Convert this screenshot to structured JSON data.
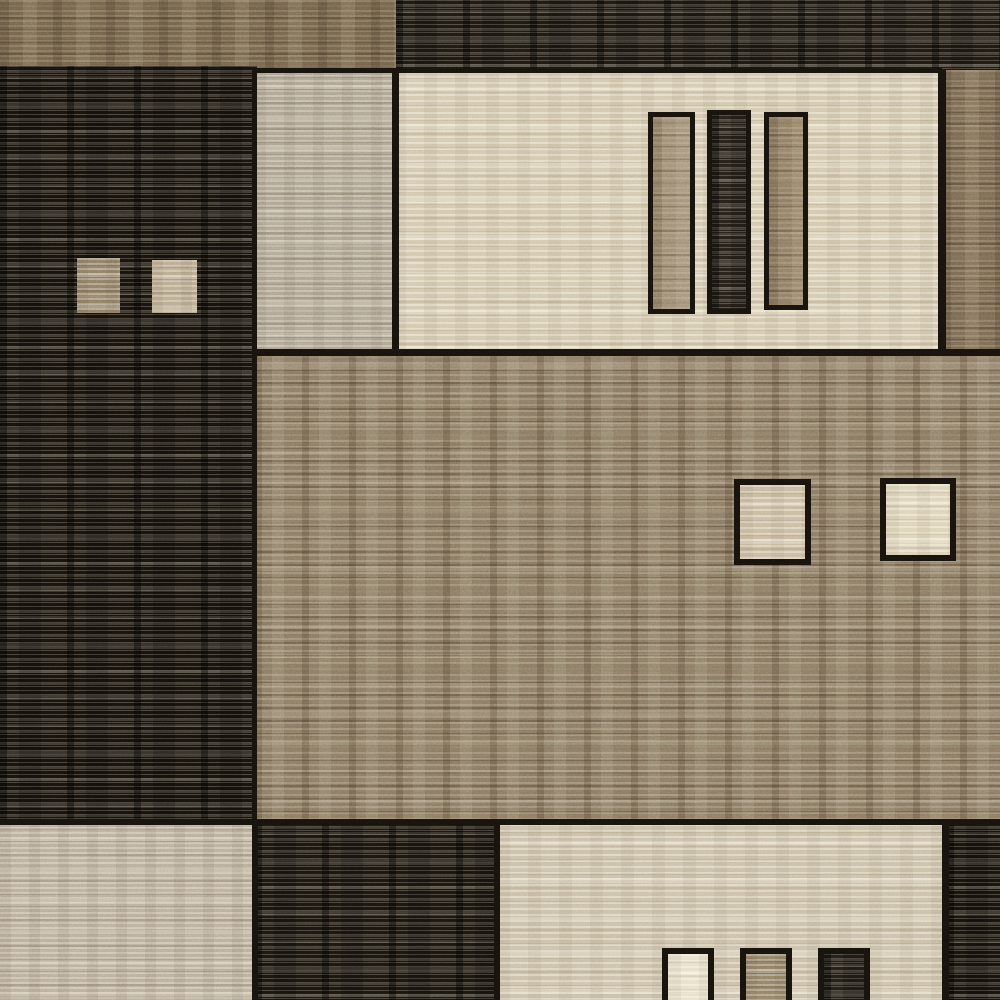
{
  "meta": {
    "description": "Close-up photograph of a geometric patchwork area rug in brown, taupe, beige and cream tones with horizontal woven striations",
    "width": 1000,
    "height": 1000
  },
  "palette": {
    "outline": "#17120d",
    "near_black": "#17120d",
    "dark_brown": "#1d1812",
    "taupe_brown": "#6f6049",
    "tan_field": "#85755f",
    "greige": "#aba08c",
    "cream": "#d2c6ab",
    "warm_beige": "#c9bda4",
    "gray_beige": "#b7ab96"
  },
  "blocks": [
    {
      "name": "top-brown-strip",
      "x": 0,
      "y": 0,
      "w": 396,
      "h": 72,
      "color": "#6f6049",
      "texture": "mottled"
    },
    {
      "name": "top-dark-strip",
      "x": 396,
      "y": 0,
      "w": 604,
      "h": 72,
      "color": "#1d1812",
      "texture": "darkstripes"
    },
    {
      "name": "left-dark-column",
      "x": 0,
      "y": 66,
      "w": 257,
      "h": 756,
      "color": "#17120d",
      "texture": "darkstripes"
    },
    {
      "name": "beige-left-sub-block",
      "x": 255,
      "y": 70,
      "w": 140,
      "h": 282,
      "color": "#aba08c",
      "texture": "stripes"
    },
    {
      "name": "beige-main-block",
      "x": 393,
      "y": 70,
      "w": 549,
      "h": 284,
      "color": "#d2c6ab",
      "texture": "lightstripes"
    },
    {
      "name": "right-brown-strip",
      "x": 942,
      "y": 70,
      "w": 58,
      "h": 286,
      "color": "#75654f",
      "texture": "mottled"
    },
    {
      "name": "tan-center-field",
      "x": 255,
      "y": 350,
      "w": 745,
      "h": 472,
      "color": "#85755f",
      "texture": "mottledstrong"
    },
    {
      "name": "bottom-left-beige-block",
      "x": 0,
      "y": 822,
      "w": 255,
      "h": 178,
      "color": "#b7ab96",
      "texture": "stripes"
    },
    {
      "name": "bottom-dark-block",
      "x": 255,
      "y": 822,
      "w": 242,
      "h": 178,
      "color": "#1a150f",
      "texture": "darkstripes"
    },
    {
      "name": "bottom-beige-block",
      "x": 497,
      "y": 824,
      "w": 450,
      "h": 176,
      "color": "#c9bda4",
      "texture": "lightstripes"
    },
    {
      "name": "bottom-right-dark-block",
      "x": 947,
      "y": 822,
      "w": 53,
      "h": 178,
      "color": "#17120d",
      "texture": "darkstripes"
    }
  ],
  "seams": [
    {
      "name": "seam-beige-top",
      "x": 255,
      "y": 68,
      "w": 687,
      "h": 5
    },
    {
      "name": "seam-beige-split-vertical",
      "x": 392,
      "y": 70,
      "w": 7,
      "h": 282
    },
    {
      "name": "seam-beige-right-vertical",
      "x": 938,
      "y": 70,
      "w": 8,
      "h": 284
    },
    {
      "name": "seam-under-beige",
      "x": 255,
      "y": 349,
      "w": 745,
      "h": 7
    },
    {
      "name": "seam-left-column-right",
      "x": 252,
      "y": 70,
      "w": 5,
      "h": 752
    },
    {
      "name": "seam-bottom-row",
      "x": 0,
      "y": 819,
      "w": 1000,
      "h": 6
    },
    {
      "name": "seam-bottom-left-split",
      "x": 252,
      "y": 822,
      "w": 6,
      "h": 178
    },
    {
      "name": "seam-bottom-beige-left",
      "x": 494,
      "y": 824,
      "w": 6,
      "h": 176
    },
    {
      "name": "seam-bottom-beige-right",
      "x": 942,
      "y": 822,
      "w": 7,
      "h": 178
    }
  ],
  "features": [
    {
      "name": "vertical-bar-tan-1",
      "x": 648,
      "y": 112,
      "w": 47,
      "h": 202,
      "color": "#9a8870",
      "outline": 5,
      "texture": "mottled"
    },
    {
      "name": "vertical-bar-dark",
      "x": 707,
      "y": 110,
      "w": 44,
      "h": 204,
      "color": "#262019",
      "outline": 5,
      "texture": "darkstripes"
    },
    {
      "name": "vertical-bar-tan-2",
      "x": 764,
      "y": 112,
      "w": 44,
      "h": 198,
      "color": "#8b7960",
      "outline": 5,
      "texture": "mottled"
    },
    {
      "name": "left-small-square-tan",
      "x": 77,
      "y": 258,
      "w": 43,
      "h": 55,
      "color": "#8c7b61",
      "outline": 0,
      "texture": "stripes"
    },
    {
      "name": "left-small-square-beige",
      "x": 152,
      "y": 260,
      "w": 45,
      "h": 53,
      "color": "#b7a88b",
      "outline": 0,
      "texture": "stripes"
    },
    {
      "name": "center-square-beige",
      "x": 734,
      "y": 479,
      "w": 77,
      "h": 86,
      "color": "#c7b89c",
      "outline": 6,
      "texture": "lightstripes"
    },
    {
      "name": "center-square-cream",
      "x": 880,
      "y": 478,
      "w": 76,
      "h": 83,
      "color": "#dcd1b5",
      "outline": 6,
      "texture": "lightstripes"
    },
    {
      "name": "bottom-square-cream",
      "x": 662,
      "y": 948,
      "w": 52,
      "h": 60,
      "color": "#e7dfc7",
      "outline": 6,
      "texture": "lightstripes"
    },
    {
      "name": "bottom-square-tan",
      "x": 740,
      "y": 948,
      "w": 52,
      "h": 60,
      "color": "#8d7c62",
      "outline": 6,
      "texture": "stripes"
    },
    {
      "name": "bottom-square-dark",
      "x": 818,
      "y": 948,
      "w": 52,
      "h": 60,
      "color": "#221d17",
      "outline": 6,
      "texture": "darkstripes"
    }
  ]
}
